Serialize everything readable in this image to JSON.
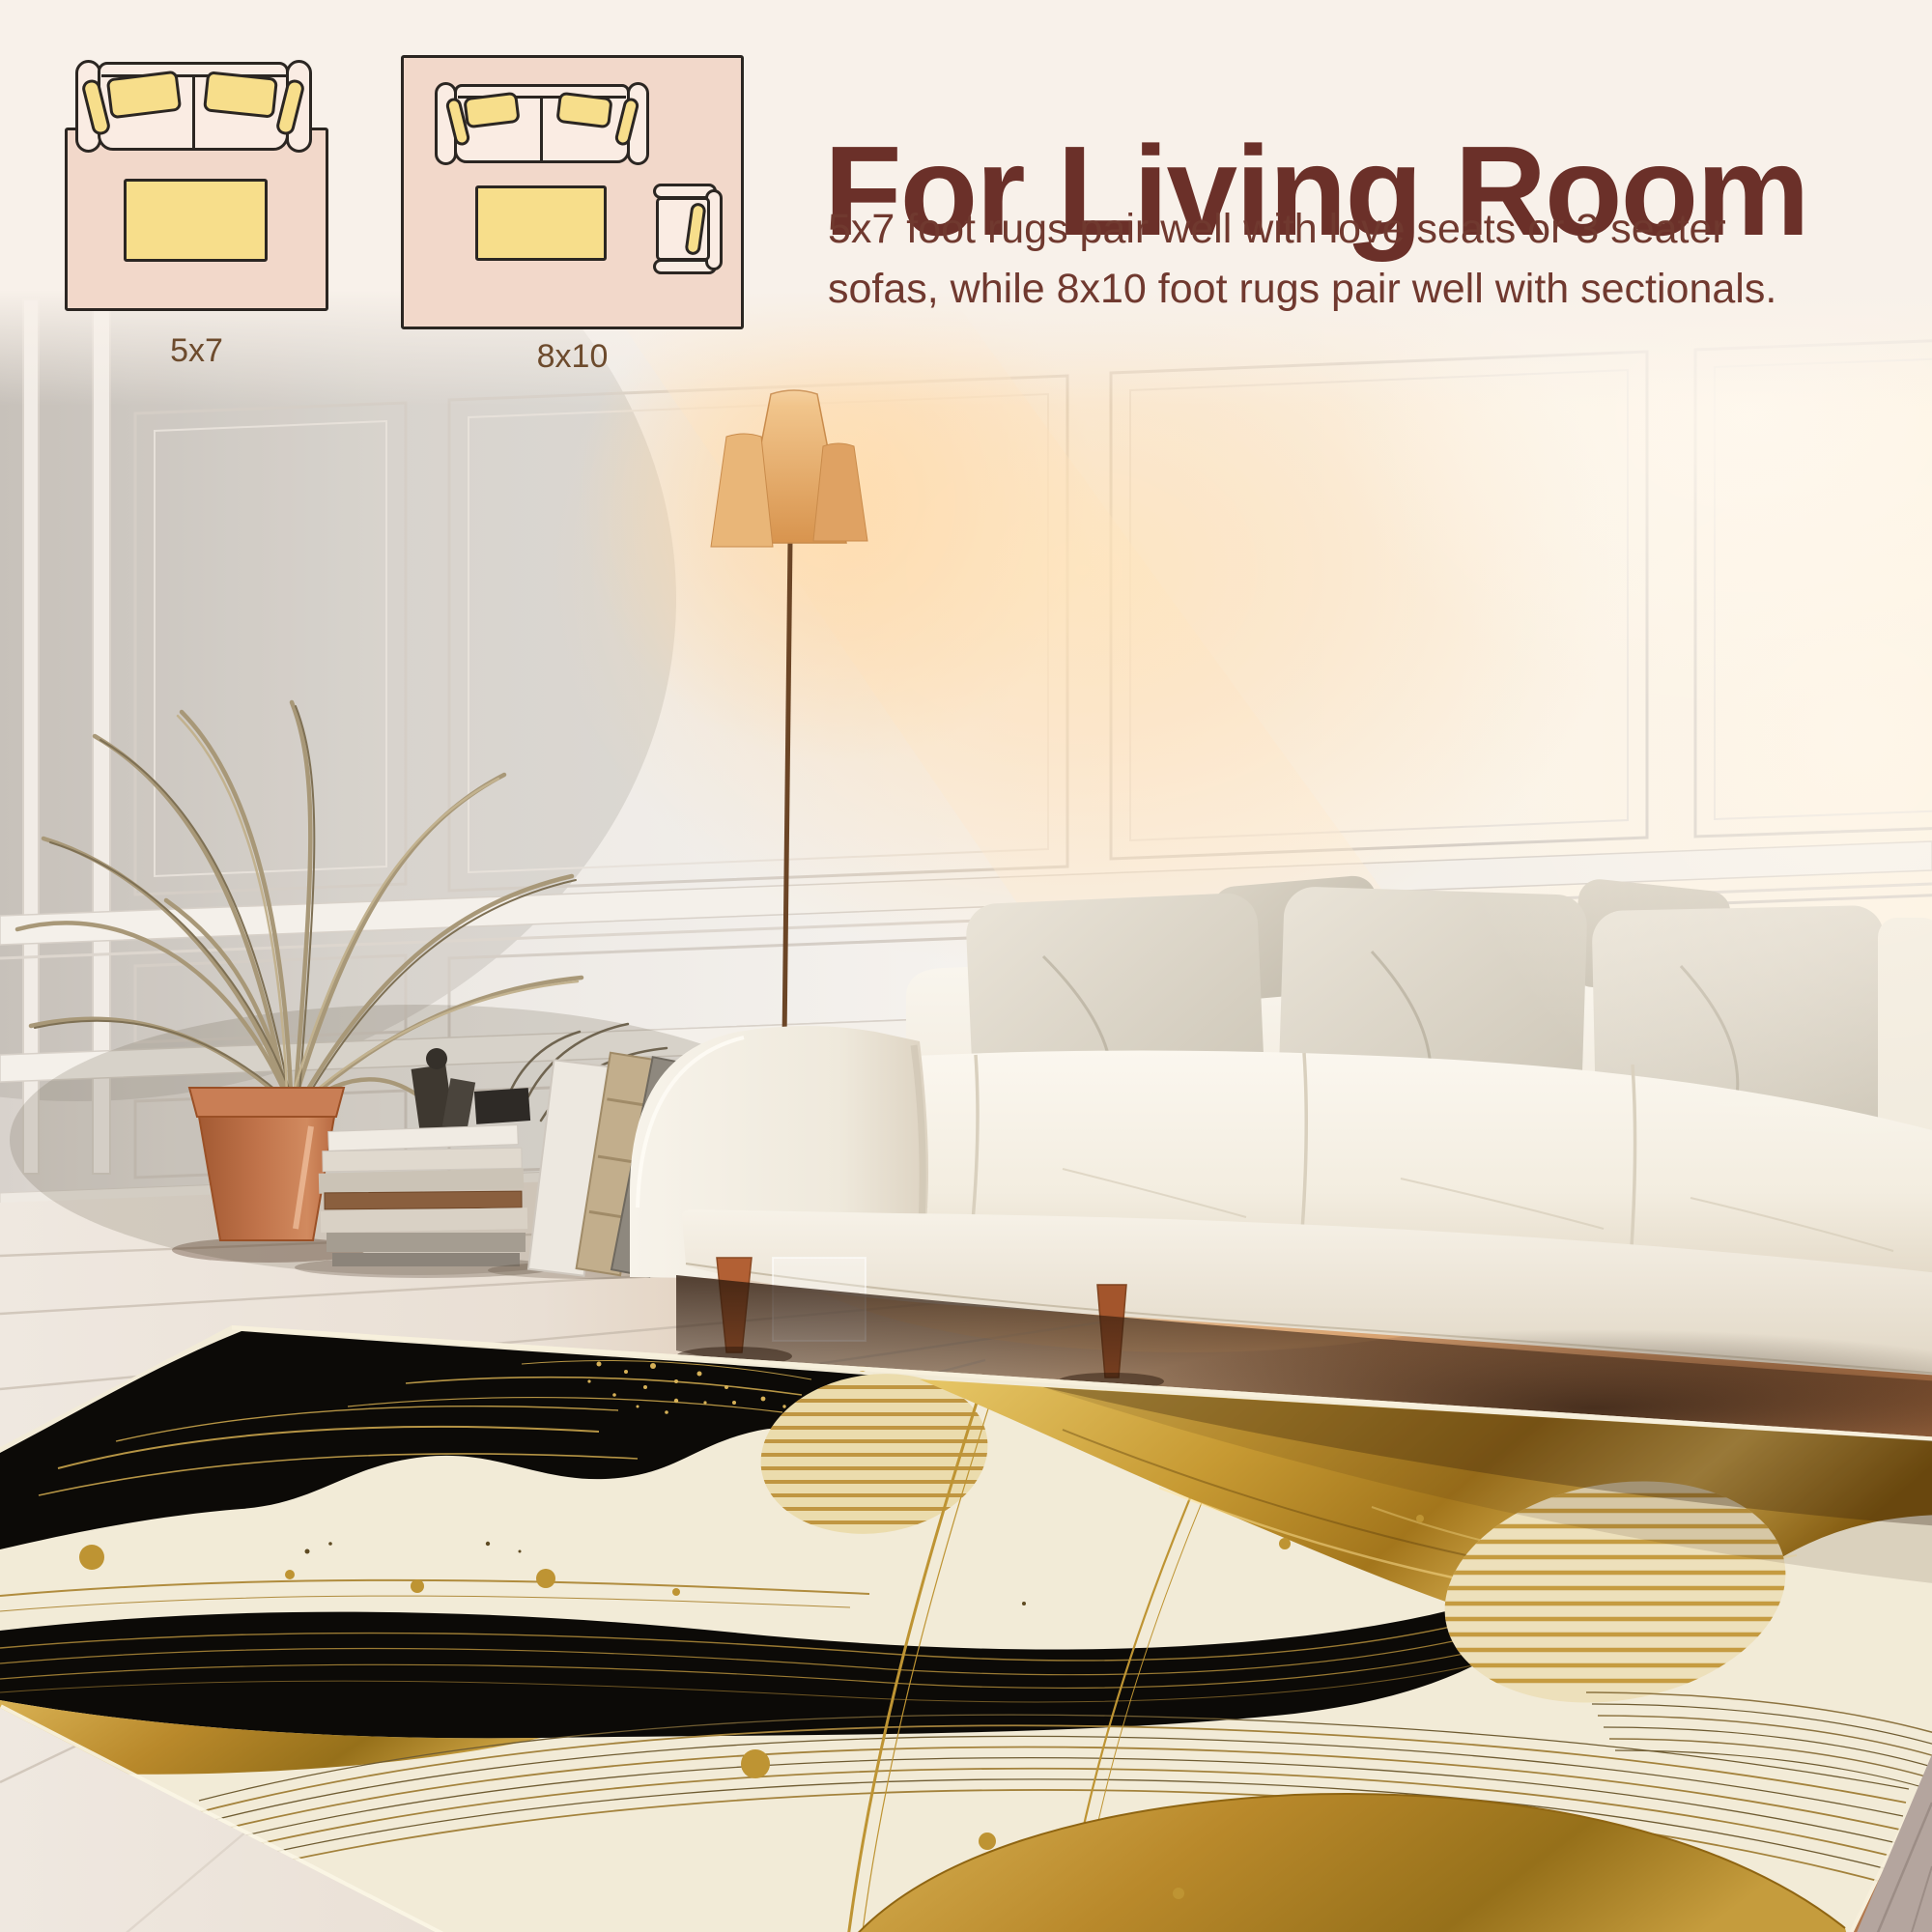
{
  "page": {
    "type": "rug-product-size-guide",
    "background_color": "#F8F1EA"
  },
  "header": {
    "title": "For Living Room",
    "line1": "5x7 foot rugs pair well with love seats or 3 seater",
    "line2": "sofas, while 8x10 foot rugs pair well with sectionals.",
    "title_color": "#6B3029",
    "body_color": "#70392F"
  },
  "diagrams": [
    {
      "label": "5x7",
      "icon": "rug-with-loveseat-top-view-diagram",
      "elements": [
        "rug",
        "sofa",
        "coffee-table"
      ]
    },
    {
      "label": "8x10",
      "icon": "rug-with-sofa-and-armchair-top-view-diagram",
      "elements": [
        "rug",
        "sofa",
        "coffee-table",
        "armchair"
      ]
    }
  ],
  "diagram_style": {
    "rug_fill": "#F2D8CA",
    "furniture_fill": "#FAECE3",
    "cushion_fill": "#F7DE8B",
    "outline": "#2B2622",
    "label_color": "#6D4B2D"
  },
  "scene": {
    "type": "living-room-photo",
    "elements": [
      "white-paneled-wall",
      "floor-lamp",
      "dried-palm-plant",
      "terracotta-pot",
      "stacked-books",
      "leaning-canvases",
      "grey-vase",
      "white-sofa",
      "grey-throw-pillows",
      "whitewashed-wood-floor",
      "abstract-black-gold-area-rug"
    ],
    "rug_colors": {
      "cream": "#F2EBD7",
      "black": "#0C0A07",
      "gold": "#C0952F"
    }
  }
}
